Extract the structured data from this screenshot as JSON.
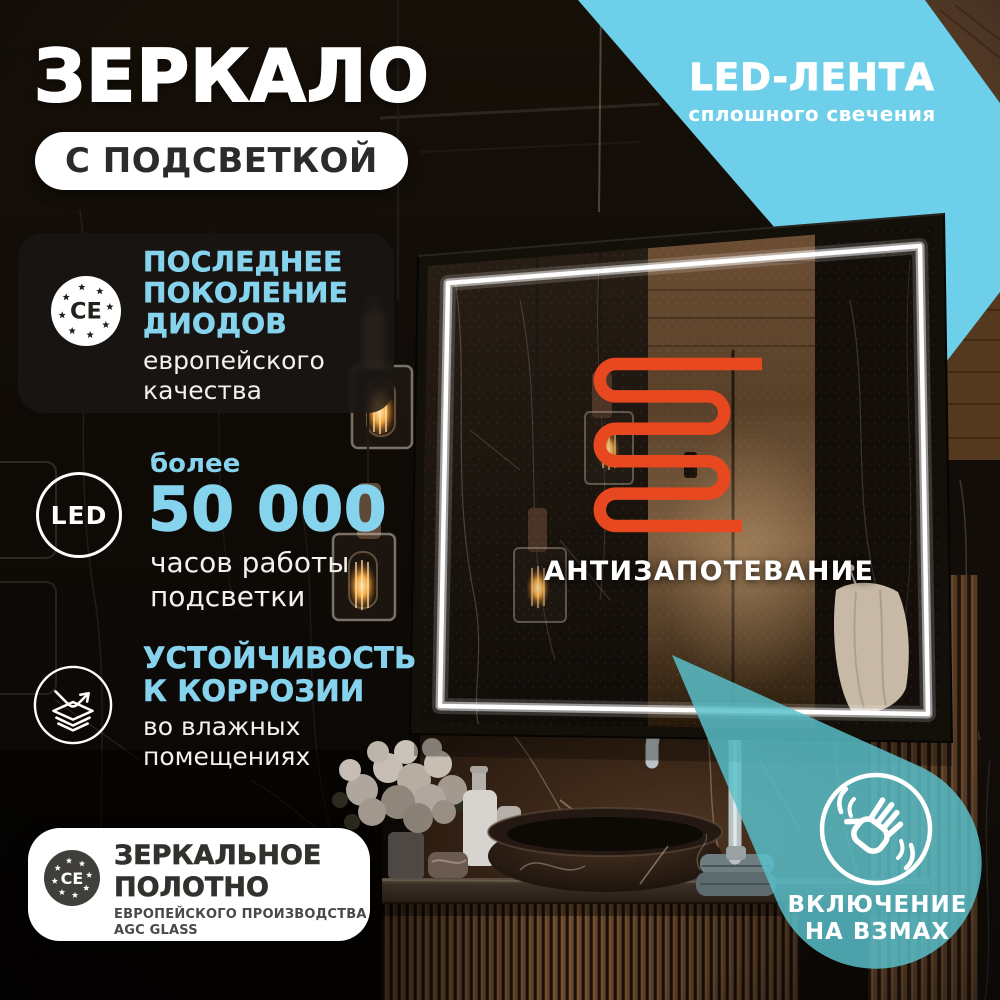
{
  "title": {
    "main": "ЗЕРКАЛО",
    "badge": "С ПОДСВЕТКОЙ"
  },
  "ribbon": {
    "title": "LED-ЛЕНТА",
    "subtitle": "сплошного свечения"
  },
  "features": [
    {
      "icon": "ce-stars-icon",
      "icon_label": "CE",
      "title_lines": [
        "ПОСЛЕДНЕЕ",
        "ПОКОЛЕНИЕ",
        "ДИОДОВ"
      ],
      "body_lines": [
        "европейского",
        "качества"
      ]
    },
    {
      "icon": "led-circle-icon",
      "icon_label": "LED",
      "intro": "более",
      "value": "50 000",
      "body_lines": [
        "часов работы",
        "подсветки"
      ]
    },
    {
      "icon": "corrosion-layers-icon",
      "title_lines": [
        "УСТОЙЧИВОСТЬ",
        "К КОРРОЗИИ"
      ],
      "body_lines": [
        "во влажных",
        "помещениях"
      ]
    }
  ],
  "mirror_overlay": {
    "icon": "heating-coil-icon",
    "label": "АНТИЗАПОТЕВАНИЕ"
  },
  "glass_badge": {
    "icon": "ce-stars-icon",
    "icon_label": "CE",
    "title_lines": [
      "ЗЕРКАЛЬНОЕ",
      "ПОЛОТНО"
    ],
    "subtitle_lines": [
      "ЕВРОПЕЙСКОГО ПРОИЗВОДСТВА",
      "AGC GLASS"
    ]
  },
  "wave_badge": {
    "icon": "hand-wave-icon",
    "lines": [
      "ВКЛЮЧЕНИЕ",
      "НА ВЗМАХ"
    ]
  },
  "colors": {
    "accent_cyan": "#86d3ee",
    "ribbon_cyan": "#6dcfe9",
    "wave_teal": "#59c0cb",
    "coil_orange": "#e8481f",
    "badge_bg": "#ffffff",
    "text_dark": "#33312e"
  }
}
